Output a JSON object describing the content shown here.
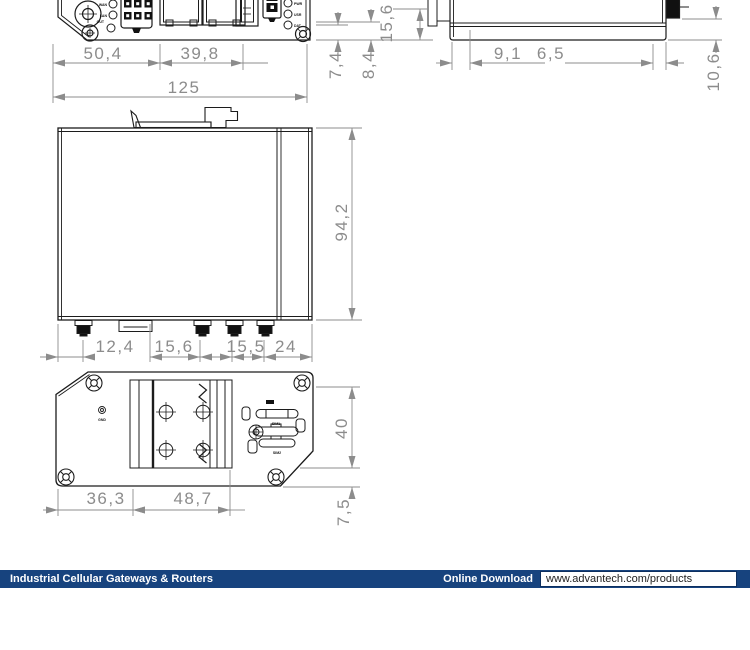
{
  "footer": {
    "left_label": "Industrial Cellular Gateways & Routers",
    "download_label": "Online Download",
    "url": "www.advantech.com/products",
    "bar_color": "#17437e"
  },
  "drawing": {
    "colors": {
      "device_line": "#1c1c1c",
      "dimension": "#8c8c8c"
    },
    "dims": {
      "front_w1": "50,4",
      "front_w2": "39,8",
      "front_total": "125",
      "front_h1": "7,4",
      "front_h2": "8,4",
      "front_h3": "15,6",
      "side_d1": "9,1",
      "side_d2": "6,5",
      "side_d3": "10,6",
      "top_h": "94,2",
      "top_b1": "12,4",
      "top_b2": "15,6",
      "top_b3": "15,5",
      "top_b4": "24",
      "bot_b1": "36,3",
      "bot_b2": "48,7",
      "bot_h": "40",
      "bot_h2": "7,5"
    },
    "labels": {
      "led_l1": "WAN",
      "led_l2": "LAN",
      "led_l3": "OUT",
      "led_r1": "PWR",
      "led_r2": "USR",
      "led_r3": "DAT",
      "gnd": "GND",
      "sim1": "SIM1",
      "sim2": "SIM2"
    }
  }
}
